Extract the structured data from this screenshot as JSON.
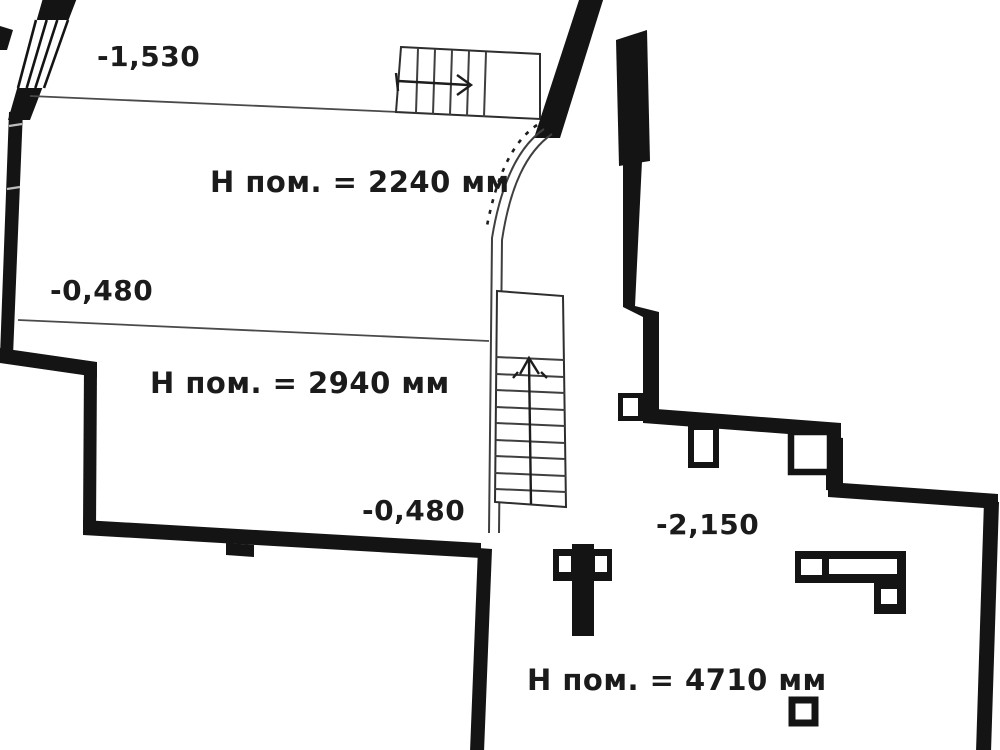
{
  "plan": {
    "type": "architectural-floor-plan",
    "language": "ru",
    "elevation_labels": [
      {
        "name": "elevation-entry",
        "text": "-1,530"
      },
      {
        "name": "elevation-upper-room",
        "text": "-0,480"
      },
      {
        "name": "elevation-middle-room",
        "text": "-0,480"
      },
      {
        "name": "elevation-lower-room",
        "text": "-2,150"
      }
    ],
    "room_height_labels": [
      {
        "name": "upper-room-height",
        "text": "Н пом. = 2240 мм"
      },
      {
        "name": "middle-room-height",
        "text": "Н пом. = 2940 мм"
      },
      {
        "name": "lower-room-height",
        "text": "Н пом. = 4710 мм"
      }
    ],
    "colors": {
      "wall": "#141414",
      "thin_line": "#3f3f3f",
      "background": "#ffffff",
      "text": "#1b1b1b"
    }
  }
}
